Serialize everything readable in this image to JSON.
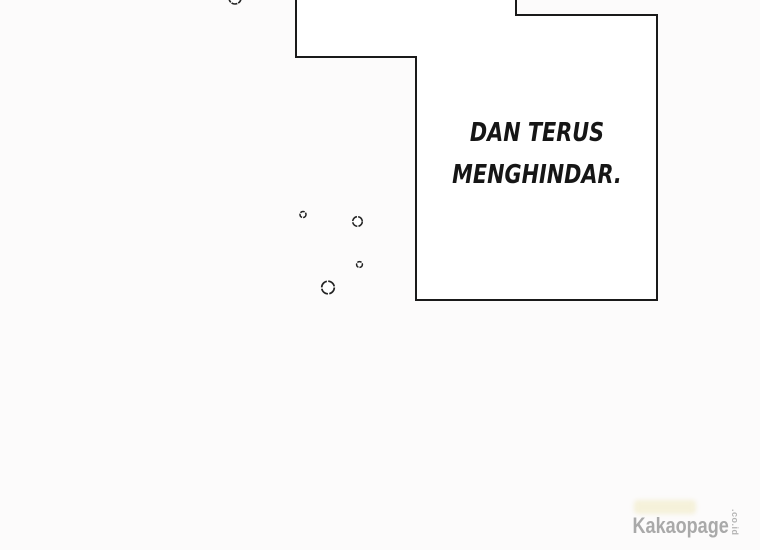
{
  "page": {
    "background_color": "#fcfbfb",
    "outline_color": "#1a1a1a"
  },
  "speech_bubble": {
    "line1": "DAN TERUS",
    "line2": "MENGHINDAR.",
    "fill_color": "#ffffff",
    "text_color": "#161616"
  },
  "watermark": {
    "brand": "Kakaopage",
    "domain_suffix": ".co.id",
    "color": "#a9a9a9"
  }
}
